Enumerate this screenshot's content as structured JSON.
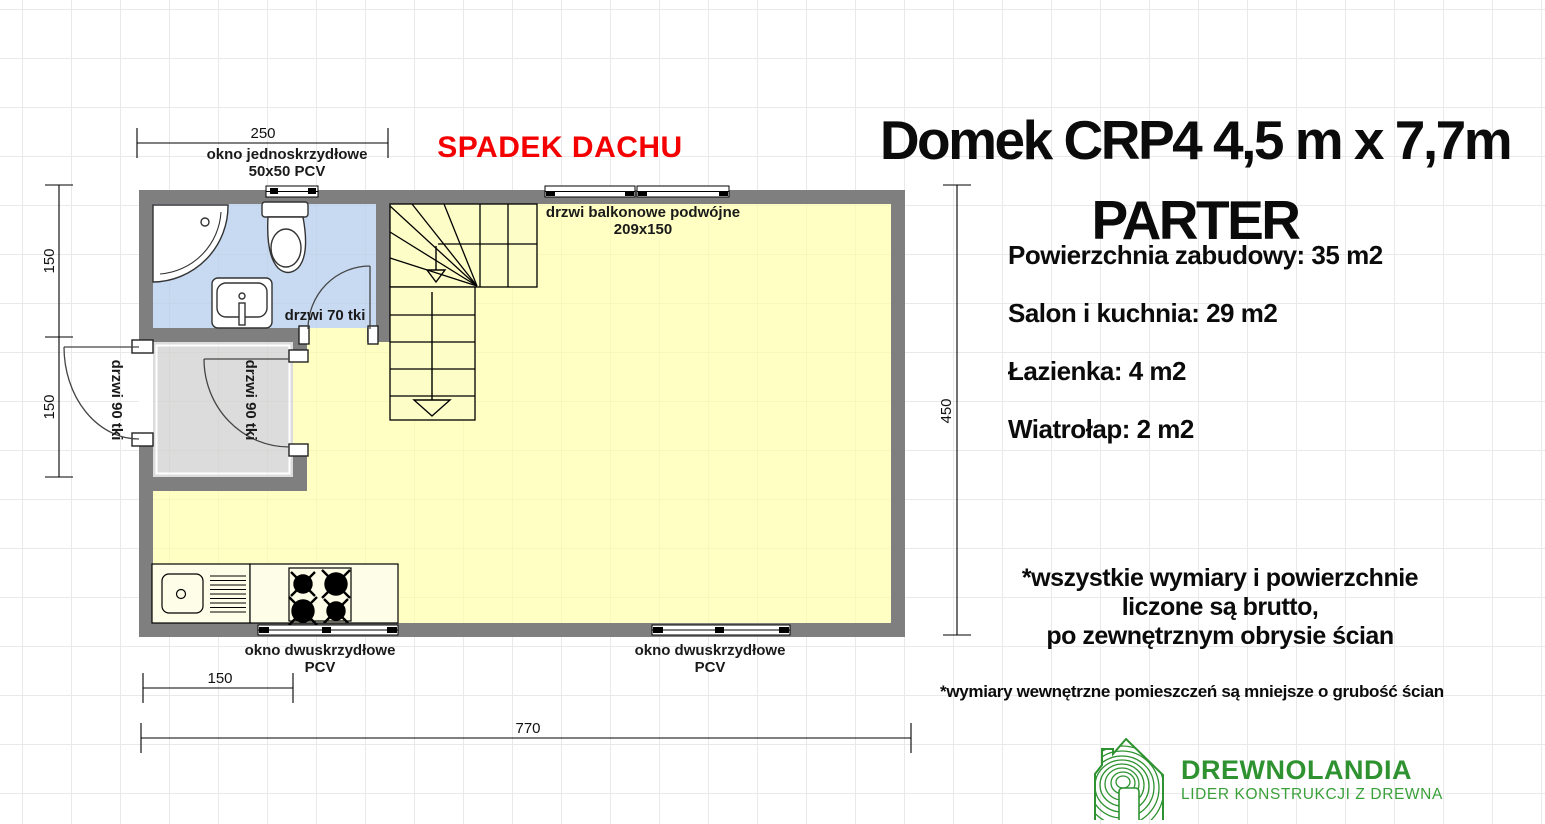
{
  "title": {
    "line1": "Domek CRP4  4,5 m x 7,7m",
    "line2": "PARTER"
  },
  "stats": {
    "built_area": "Powierzchnia zabudowy: 35 m2",
    "living_kitchen": "Salon i kuchnia: 29 m2",
    "bathroom": "Łazienka: 4 m2",
    "vestibule": "Wiatrołap: 2 m2"
  },
  "roof_note": "SPADEK DACHU",
  "plan_labels": {
    "window_top_line1": "okno jednoskrzydłowe",
    "window_top_line2": "50x50 PCV",
    "balcony_door_line1": "drzwi balkonowe podwójne",
    "balcony_door_line2": "209x150",
    "bath_door": "drzwi 70 tki",
    "entry_door": "drzwi 90 tki",
    "vestibule_door": "drzwi 90 tki",
    "window_bottom_left_line1": "okno dwuskrzydłowe",
    "window_bottom_left_line2": "PCV",
    "window_bottom_right_line1": "okno dwuskrzydłowe",
    "window_bottom_right_line2": "PCV"
  },
  "dimensions": {
    "top_width": "250",
    "left_upper": "150",
    "left_lower": "150",
    "right_height": "450",
    "bottom_small": "150",
    "bottom_total": "770"
  },
  "notes": {
    "brutto_line1": "*wszystkie wymiary i powierzchnie",
    "brutto_line2": "liczone są brutto,",
    "brutto_line3": "po zewnętrznym obrysie ścian",
    "internal": "*wymiary wewnętrzne pomieszczeń są mniejsze o grubość ścian"
  },
  "logo": {
    "name": "DREWNOLANDIA",
    "tagline": "LIDER KONSTRUKCJI Z DREWNA"
  },
  "colors": {
    "wall": "#7f7f7f",
    "floor": "#ffffc3",
    "bathroom": "#c7daf2",
    "vestibule": "#dcdcdc",
    "roof_note_red": "#f40000",
    "logo_green": "#2e9230"
  }
}
